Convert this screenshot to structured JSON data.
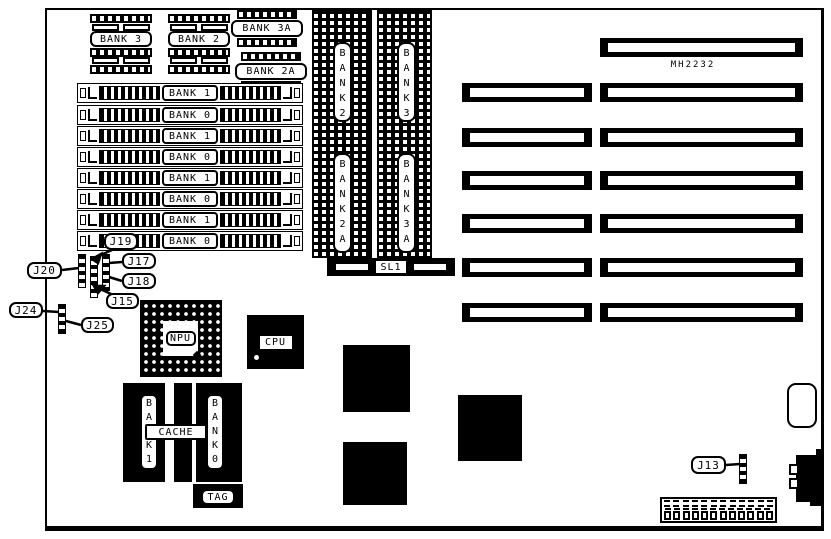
{
  "diagram": {
    "chip_label": "MH2232",
    "dip_sockets": {
      "bank3": "BANK 3",
      "bank2": "BANK 2",
      "bank3a": "BANK 3A",
      "bank2a": "BANK 2A"
    },
    "simm_rows": [
      "BANK 1",
      "BANK 0",
      "BANK 1",
      "BANK 0",
      "BANK 1",
      "BANK 0",
      "BANK 1",
      "BANK 0"
    ],
    "dram_columns": {
      "bank2": "BANK2",
      "bank3": "BANK3",
      "bank2a": "BANK2A",
      "bank3a": "BANK3A"
    },
    "sl1_label": "SL1",
    "jumpers": {
      "j19": "J19",
      "j20": "J20",
      "j17": "J17",
      "j18": "J18",
      "j15": "J15",
      "j24": "J24",
      "j25": "J25",
      "j13": "J13"
    },
    "processors": {
      "npu": "NPU",
      "cpu": "CPU"
    },
    "cache": {
      "label": "CACHE",
      "bank1": "BANK1",
      "bank0": "BANK0",
      "tag": "TAG"
    }
  }
}
